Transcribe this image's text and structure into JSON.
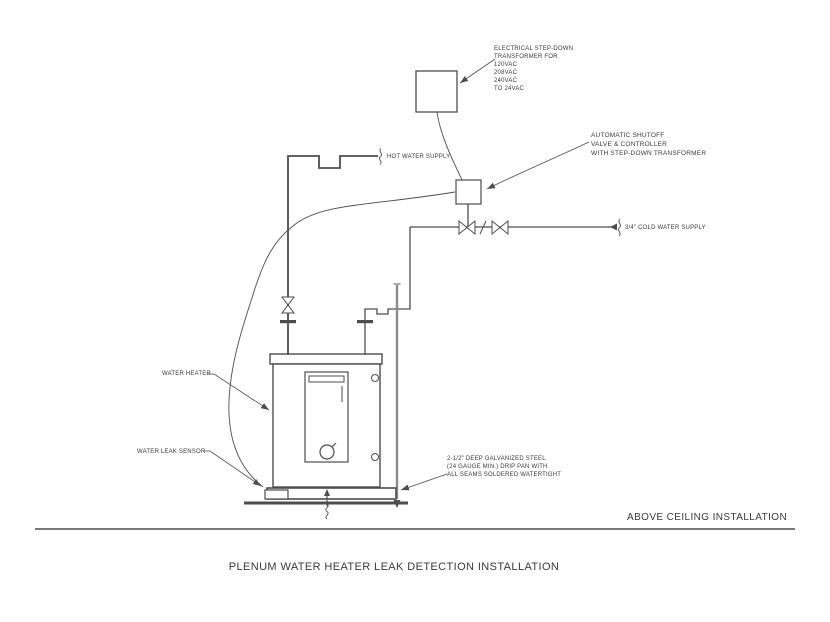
{
  "page": {
    "title": "PLENUM WATER HEATER LEAK DETECTION INSTALLATION",
    "view_label": "ABOVE CEILING INSTALLATION"
  },
  "annotations": {
    "transformer_note": "ELECTRICAL STEP-DOWN\nTRANSFORMER FOR\n120VAC\n208VAC\n240VAC\nTO 24VAC",
    "shutoff_note": "AUTOMATIC SHUTOFF\nVALVE & CONTROLLER\nWITH STEP-DOWN TRANSFORMER",
    "hot_water_label": "HOT WATER SUPPLY",
    "cold_water_label": "3/4\" COLD WATER SUPPLY",
    "water_heater_label": "WATER HEATER",
    "leak_sensor_label": "WATER LEAK SENSOR",
    "drip_pan_note": "2-1/2\" DEEP GALVANIZED STEEL\n(24 GAUGE MIN.) DRIP PAN WITH\nALL SEAMS SOLDERED WATERTIGHT"
  },
  "colors": {
    "line-color": "#4d4d4d",
    "text-color": "#3a3a3a",
    "pipe-gray": "#8a8a8a",
    "bg-color": "#ffffff"
  }
}
